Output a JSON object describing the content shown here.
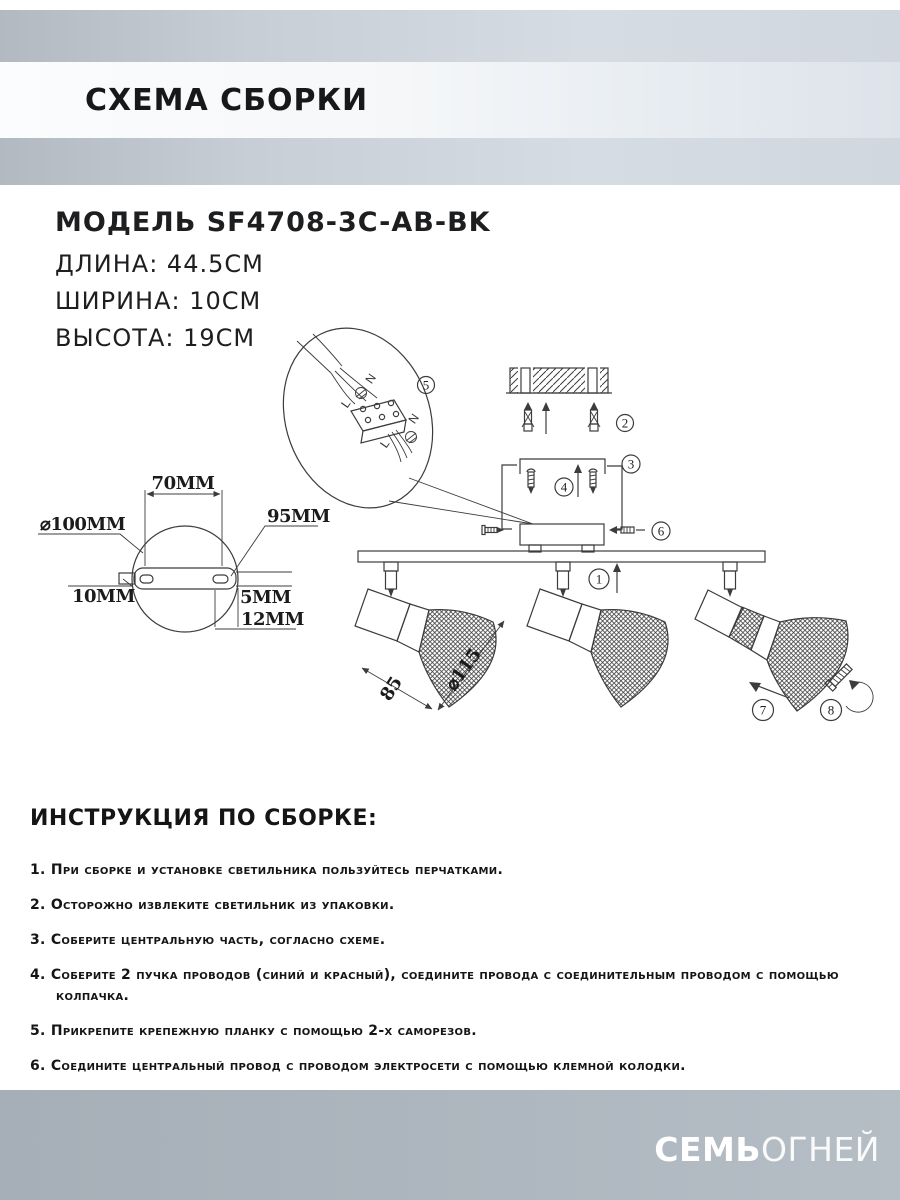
{
  "header": {
    "title": "СХЕМА СБОРКИ"
  },
  "specs": {
    "model": "МОДЕЛЬ SF4708-3C-AB-BK",
    "length": "ДЛИНА: 44.5СМ",
    "width": "ШИРИНА: 10СМ",
    "height": "ВЫСОТА: 19СМ"
  },
  "diagram": {
    "dimensions": {
      "d70": "70MM",
      "d100": "⌀100MM",
      "d95": "95MM",
      "d10": "10MM",
      "d5": "5MM",
      "d12": "12MM",
      "d85": "85",
      "d115": "⌀115"
    },
    "wire_labels": {
      "n": "N",
      "l": "L"
    },
    "markers": {
      "m1": "1",
      "m2": "2",
      "m3": "3",
      "m4": "4",
      "m5": "5",
      "m6": "6",
      "m7": "7",
      "m8": "8"
    }
  },
  "instructions": {
    "heading": "ИНСТРУКЦИЯ ПО СБОРКЕ:",
    "items": [
      {
        "num": "1.",
        "text": "При сборке и установке светильника пользуйтесь перчатками."
      },
      {
        "num": "2.",
        "text": "Осторожно извлеките светильник из упаковки."
      },
      {
        "num": "3.",
        "text": "Соберите центральную часть, согласно схеме."
      },
      {
        "num": "4.",
        "text": "Соберите 2 пучка проводов (синий и красный), соедините провода с соединительным проводом с помощью колпачка."
      },
      {
        "num": "5.",
        "text": "Прикрепите крепежную планку с помощью 2-х саморезов."
      },
      {
        "num": "6.",
        "text": "Соедините центральный провод с проводом электросети с помощью клемной колодки."
      }
    ]
  },
  "footer": {
    "brand_bold": "СЕМЬ",
    "brand_light": "ОГНЕЙ"
  },
  "colors": {
    "header_gray": "#c7ced6",
    "title_band": "#f5f7f9",
    "footer_gray": "#aeb6bf",
    "line": "#3c3c3c",
    "text": "#141517"
  }
}
